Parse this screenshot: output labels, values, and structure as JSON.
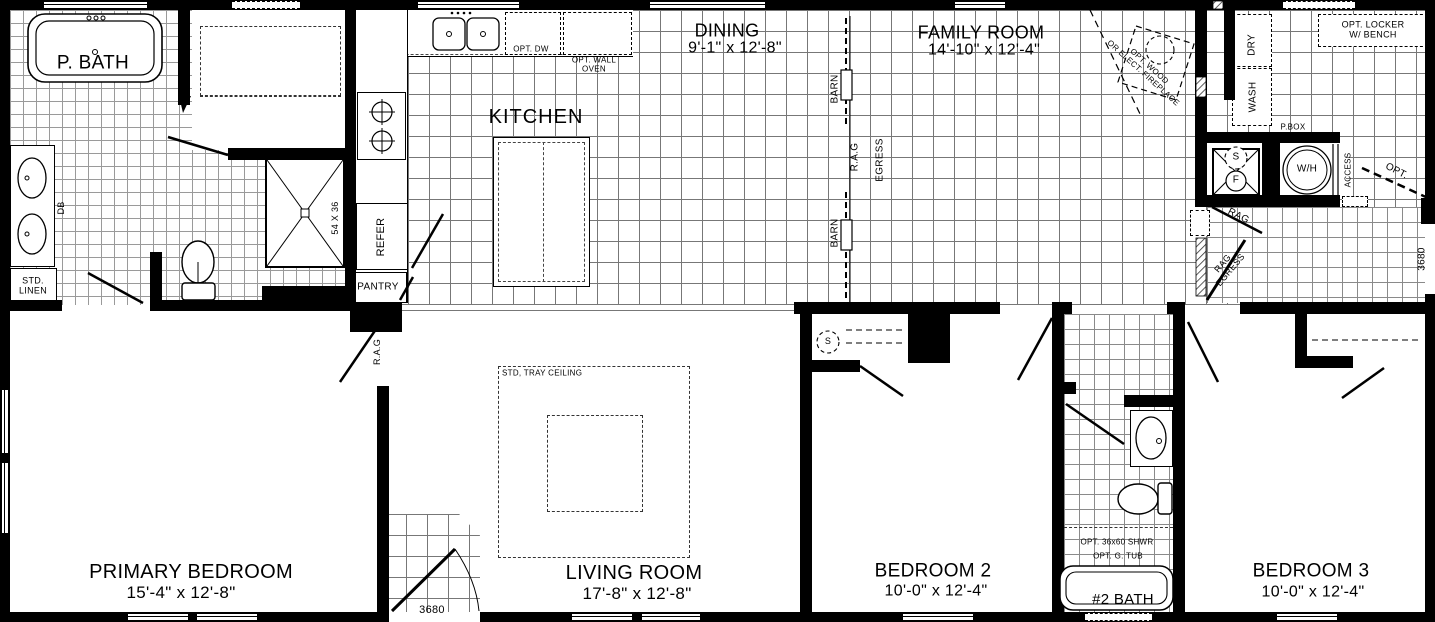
{
  "rooms": {
    "p_bath": {
      "name": "P. BATH"
    },
    "kitchen": {
      "name": "KITCHEN"
    },
    "dining": {
      "name": "DINING",
      "dims": "9'-1\" x 12'-8\""
    },
    "family_room": {
      "name": "FAMILY ROOM",
      "dims": "14'-10\" x 12'-4\""
    },
    "primary_bedroom": {
      "name": "PRIMARY BEDROOM",
      "dims": "15'-4\" x 12'-8\""
    },
    "living_room": {
      "name": "LIVING ROOM",
      "dims": "17'-8\" x 12'-8\""
    },
    "bedroom_2": {
      "name": "BEDROOM 2",
      "dims": "10'-0\" x 12'-4\""
    },
    "bedroom_3": {
      "name": "BEDROOM 3",
      "dims": "10'-0\" x 12'-4\""
    },
    "bath_2": {
      "name": "#2 BATH"
    }
  },
  "labels": {
    "std_linen_1": "STD.",
    "std_linen_2": "LINEN",
    "db": "DB",
    "shower_size": "54 X 36",
    "refer": "REFER",
    "pantry": "PANTRY",
    "opt_dw": "OPT. DW",
    "opt_wall_oven_1": "OPT. WALL",
    "opt_wall_oven_2": "OVEN",
    "barn": "BARN",
    "rag": "R.A.G",
    "egress": "EGRESS",
    "fireplace_1": "OPT. WOOD",
    "fireplace_2": "OR ELECT. FIREPLACE",
    "dry": "DRY",
    "wash": "WASH",
    "opt_locker_1": "OPT. LOCKER",
    "opt_locker_2": "W/ BENCH",
    "p_box": "P.BOX",
    "s_marker": "S",
    "furnace_f": "F",
    "water_heater": "W/H",
    "access": "ACCESS",
    "opt": "OPT.",
    "rag_door": "RAG",
    "rag_egress_1": "RAG",
    "rag_egress_2": "EGRESS",
    "tray_ceiling": "STD, TRAY CEILING",
    "opt_shower": "OPT. 36x60 SHWR",
    "opt_tub": "OPT. G. TUB",
    "door_front": "3680",
    "door_side": "3680"
  },
  "colors": {
    "wall": "#000000",
    "grid": "#777777",
    "background": "#ffffff"
  }
}
